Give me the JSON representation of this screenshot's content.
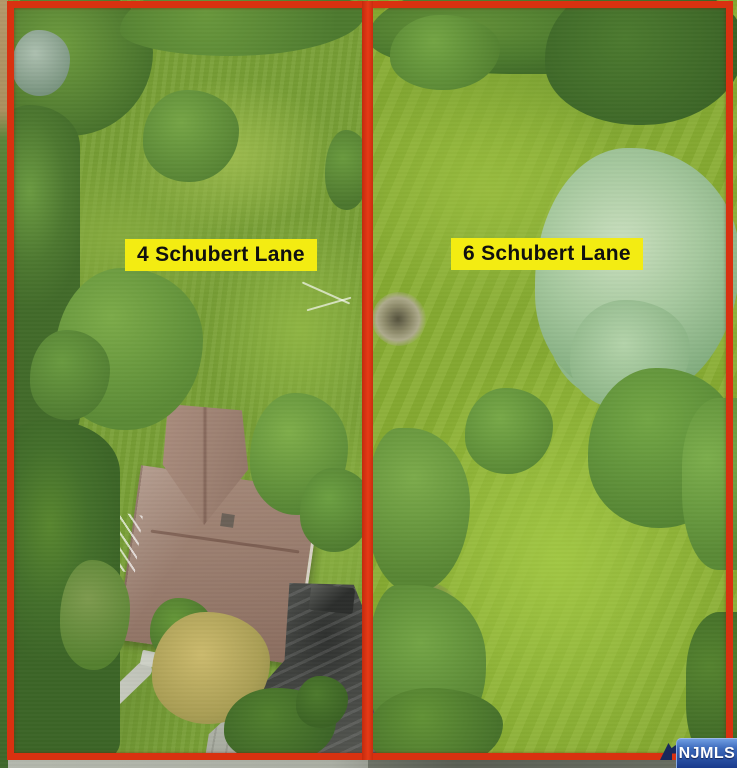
{
  "scene": {
    "description": "Aerial drone photo of two adjacent residential lots outlined in red boundary lines",
    "lots": [
      {
        "label": "4 Schubert Lane"
      },
      {
        "label": "6 Schubert Lane"
      }
    ],
    "watermark": {
      "text": "NJMLS"
    },
    "colors": {
      "boundary_red": "#d93110",
      "label_background": "#f3ec12",
      "label_text": "#101010",
      "watermark_blue_top": "#6f9de2",
      "watermark_blue_bottom": "#1a3b8d",
      "watermark_text": "#ffffff",
      "grass_left": "#79a036",
      "grass_right": "#89ae33",
      "roof_brown": "#9a7e6f"
    }
  }
}
